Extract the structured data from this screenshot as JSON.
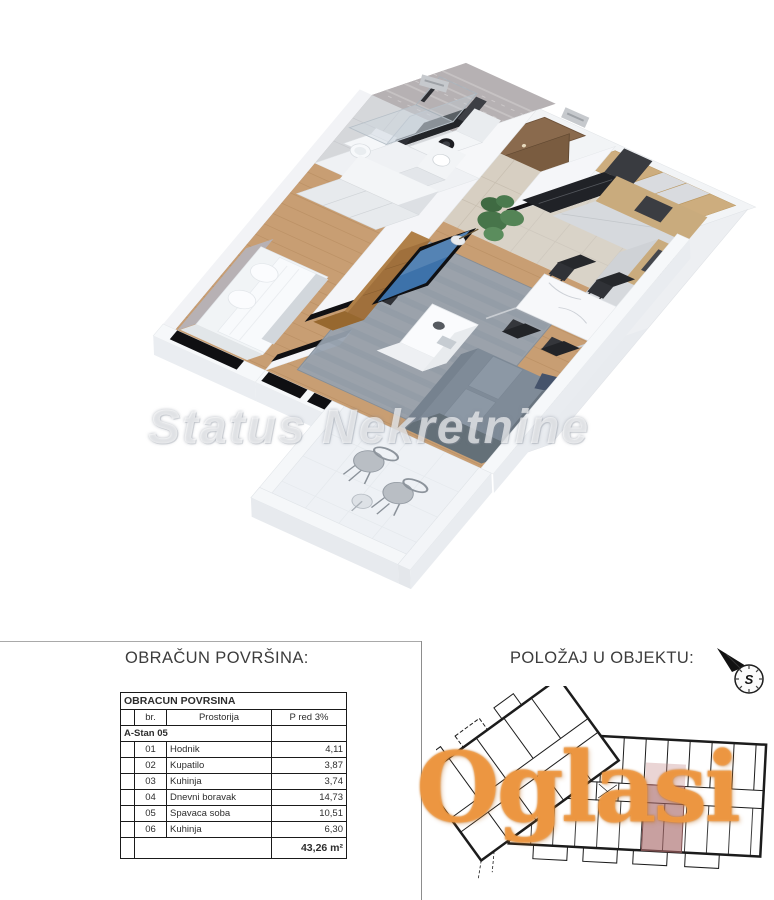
{
  "watermarks": {
    "plan_watermark": "Status Nekretnine",
    "listing_watermark": "Oglasi"
  },
  "panels": {
    "areas": {
      "heading": "OBRAČUN POVRŠINA:",
      "table": {
        "title": "OBRACUN POVRSINA",
        "col_br": "br.",
        "col_room": "Prostorija",
        "col_area": "P red 3%",
        "unit": "A-Stan 05",
        "rows": [
          {
            "br": "01",
            "room": "Hodnik",
            "area": "4,11"
          },
          {
            "br": "02",
            "room": "Kupatilo",
            "area": "3,87"
          },
          {
            "br": "03",
            "room": "Kuhinja",
            "area": "3,74"
          },
          {
            "br": "04",
            "room": "Dnevni boravak",
            "area": "14,73"
          },
          {
            "br": "05",
            "room": "Spavaca soba",
            "area": "10,51"
          },
          {
            "br": "06",
            "room": "Kuhinja",
            "area": "6,30"
          }
        ],
        "total": "43,26 m²"
      }
    },
    "position": {
      "heading": "POLOŽAJ U OBJEKTU:",
      "compass": "S"
    }
  }
}
